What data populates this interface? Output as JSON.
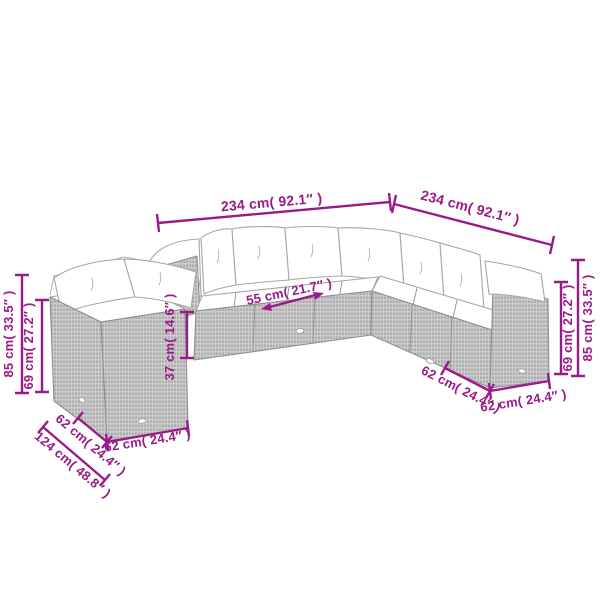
{
  "meta": {
    "accent_color": "#9A1A87",
    "background_color": "#FFFFFF",
    "artwork_line_color": "#A6A6A6",
    "description": "Dimension diagram of a modular rattan garden lounge sofa set (L-shaped sofa plus separate corner chair), line-art style with magenta measurements"
  },
  "diagram": {
    "measurements": {
      "total_front": {
        "label": "234 cm( 92.1″ )",
        "cm": 234,
        "inch": 92.1
      },
      "total_right": {
        "label": "234 cm( 92.1″ )",
        "cm": 234,
        "inch": 92.1
      },
      "left_back_height": {
        "label": "85 cm( 33.5″ )",
        "cm": 85,
        "inch": 33.5
      },
      "left_frame_height": {
        "label": "69 cm( 27.2″ )",
        "cm": 69,
        "inch": 27.2
      },
      "right_back_height": {
        "label": "85 cm( 33.5″ )",
        "cm": 85,
        "inch": 33.5
      },
      "right_frame_height": {
        "label": "69 cm( 27.2″ )",
        "cm": 69,
        "inch": 27.2
      },
      "seat_cushion_width": {
        "label": "55 cm( 21.7″ )",
        "cm": 55,
        "inch": 21.7
      },
      "seat_height": {
        "label": "37 cm( 14.6″ )",
        "cm": 37,
        "inch": 14.6
      },
      "left_module_depth": {
        "label": "62 cm( 24.4″ )",
        "cm": 62,
        "inch": 24.4
      },
      "left_total_depth": {
        "label": "124 cm( 48.8″ )",
        "cm": 124,
        "inch": 48.8
      },
      "left_module_width": {
        "label": "62 cm( 24.4″ )",
        "cm": 62,
        "inch": 24.4
      },
      "right_module_depth": {
        "label": "62 cm( 24.4″ )",
        "cm": 62,
        "inch": 24.4
      },
      "right_module_width": {
        "label": "62 cm( 24.4″ )",
        "cm": 62,
        "inch": 24.4
      }
    }
  }
}
